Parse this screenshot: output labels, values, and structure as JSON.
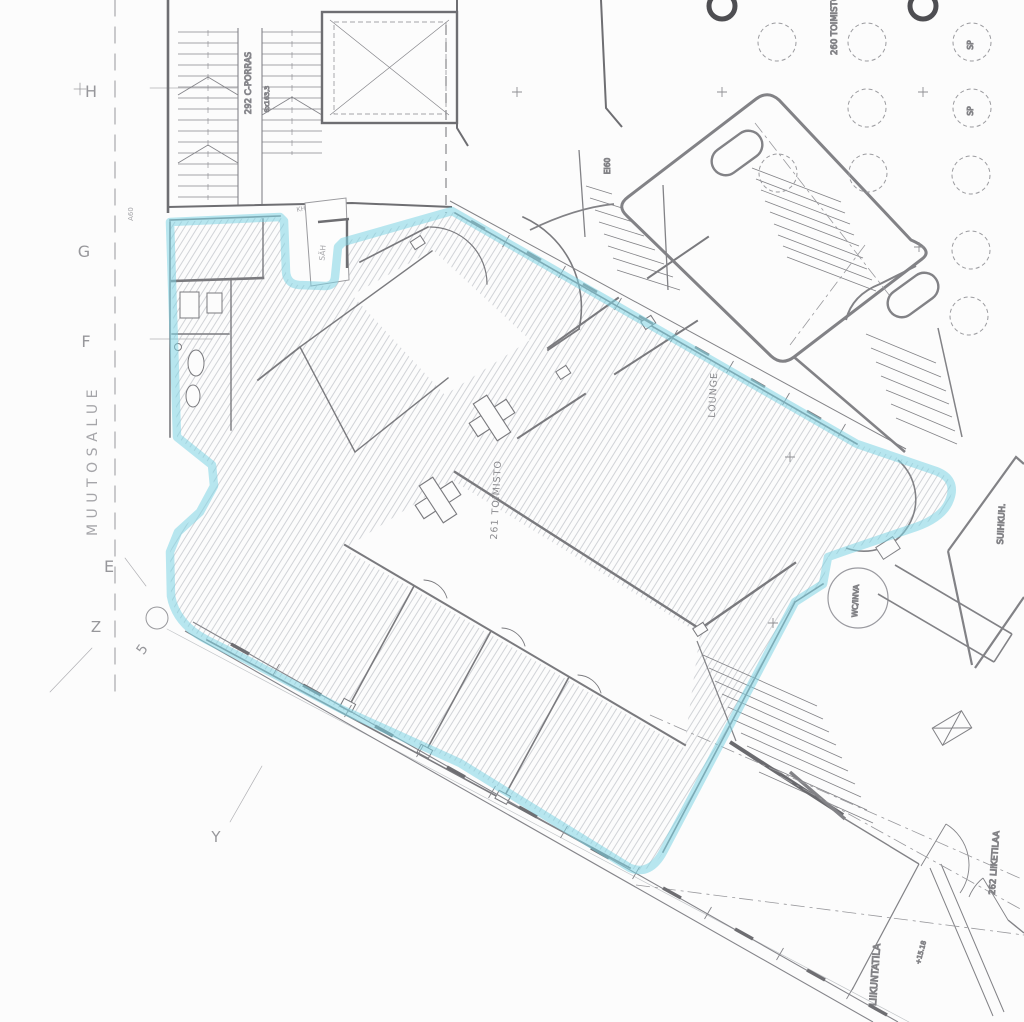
{
  "document": {
    "type": "architectural floor plan with renovation area highlight",
    "highlight_color": "#7ed3e4",
    "paper_color": "#fcfcfc",
    "wall_color": "#77777b"
  },
  "grid": {
    "h": "H",
    "g": "G",
    "f": "F",
    "e": "E",
    "z": "Z",
    "y": "Y",
    "five": "5"
  },
  "labels": {
    "muutosalue": "MUUTOSALUE",
    "a60": "A60",
    "stair_c": "292 C-PORRAS",
    "stair_dim": "8x163,3",
    "kh": "KH",
    "sah": "SÄH",
    "ei60": "EI60",
    "toimisto_260": "260 TOIMISTO",
    "sp_1": "SP",
    "sp_2": "SP",
    "lounge": "LOUNGE",
    "toimisto_261": "261 TOIMISTO",
    "suihku": "SUIHKUH.",
    "wc_inva": "WC/INVA",
    "liiketila_262": "262 LIIKETILAA",
    "liikuntatila": "LIIKUNTATILA",
    "elevation": "+15.18"
  }
}
